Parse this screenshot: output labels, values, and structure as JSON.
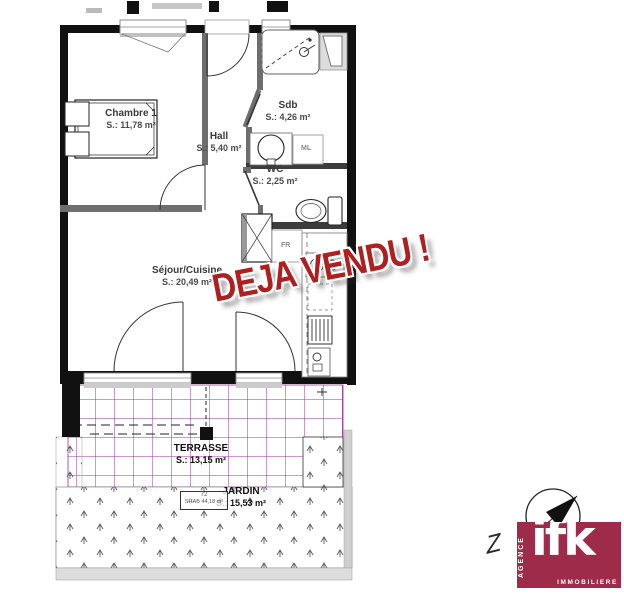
{
  "plan": {
    "rooms": [
      {
        "id": "chambre1",
        "name": "Chambre 1",
        "area": "S.: 11,78 m²"
      },
      {
        "id": "hall",
        "name": "Hall",
        "area": "S.: 5,40 m²"
      },
      {
        "id": "sdb",
        "name": "Sdb",
        "area": "S.: 4,26 m²"
      },
      {
        "id": "wc",
        "name": "WC",
        "area": "S.: 2,25 m²"
      },
      {
        "id": "sejour",
        "name": "Séjour/Cuisine",
        "area": "S.: 20,49 m²"
      },
      {
        "id": "terrasse",
        "name": "TERRASSE",
        "area": "S.: 13,15 m²"
      },
      {
        "id": "jardin",
        "name": "JARDIN",
        "area": "S.: 15,53 m²"
      }
    ],
    "appliance_labels": {
      "ml": "ML",
      "fr": "FR"
    },
    "unit_tag": {
      "number": "72",
      "shab": "SHAB 44,18 m²"
    }
  },
  "stamp": {
    "text": "DEJA VENDU !"
  },
  "compass": {
    "letter": "Z"
  },
  "logo": {
    "brand": "ifk",
    "side": "AGENCE",
    "bottom": "IMMOBILIERE"
  },
  "colors": {
    "stamp_red": "#b01f1f",
    "terrace_grid": "#993399",
    "logo_bg": "#9e2b49",
    "wall": "#111111"
  }
}
